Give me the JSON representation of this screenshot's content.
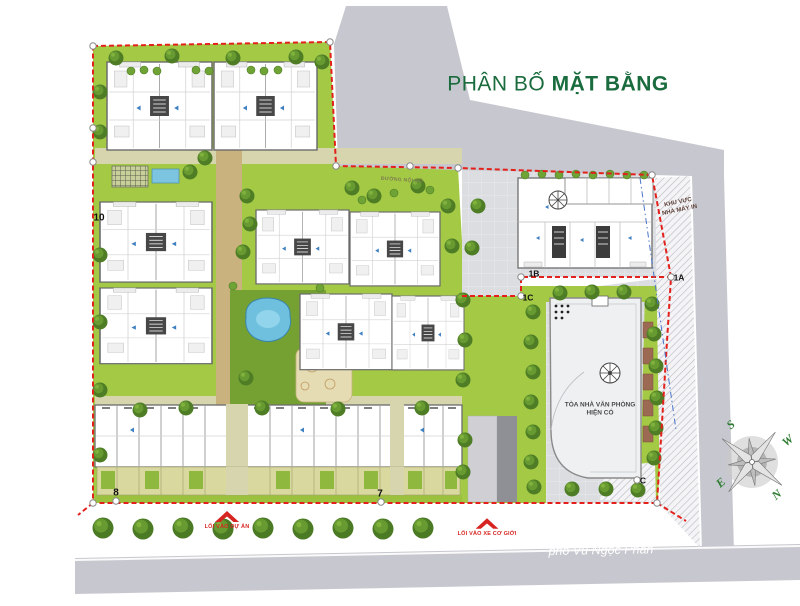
{
  "title": {
    "regular": "PHÂN BỐ ",
    "bold": "MẶT BẰNG"
  },
  "street": {
    "name": "phố Vũ Ngọc Phan"
  },
  "entrances": {
    "project": "LỐI VÀO DỰ ÁN",
    "vehicle": "LỐI VÀO XE CƠ GIỚI"
  },
  "labels": {
    "office_line1": "TÒA NHÀ VĂN PHÒNG",
    "office_line2": "HIỆN CÓ",
    "area_line1": "KHU VỰC",
    "area_line2": "NHÀ MÁY IN",
    "road_internal": "ĐƯỜNG NỘI BỘ"
  },
  "plots": {
    "block10": "10",
    "block8": "8",
    "block7": "7",
    "marker_1a": "1A",
    "marker_1b": "1B",
    "marker_1c": "1C",
    "marker_c": "C"
  },
  "compass": {
    "north": "N",
    "south": "S",
    "east": "E",
    "west": "W"
  },
  "colors": {
    "title_green": "#1a6b3d",
    "boundary_red": "#e3201b",
    "entrance_red": "#d62420",
    "lawn_green": "#a4ca45",
    "road_gray": "#c7c7cf",
    "pool_blue": "#6ec0de"
  },
  "icons": {
    "compass_rose": "8-point-star",
    "entrance_arrow": "red-gable-arrow",
    "gate_marker": "down-triangle"
  }
}
